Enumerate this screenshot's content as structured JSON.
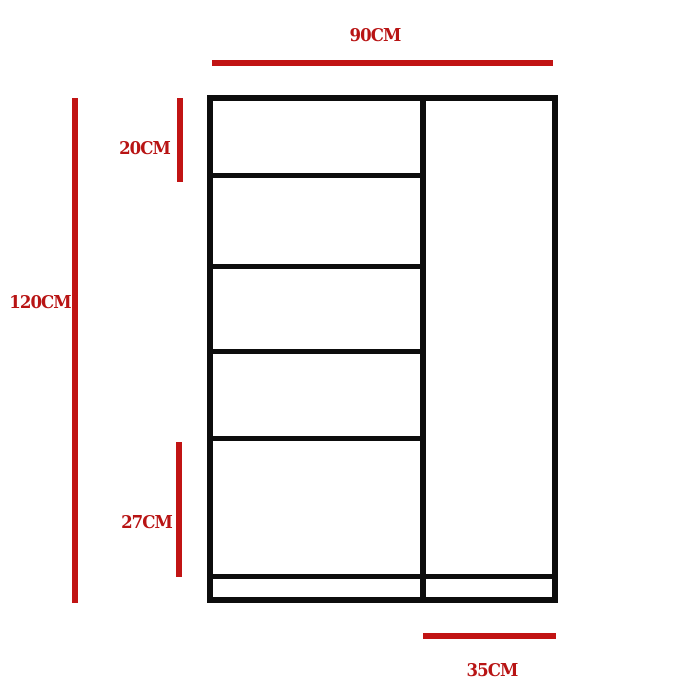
{
  "diagram": {
    "type": "furniture-dimension-drawing",
    "labels": {
      "width": "90CM",
      "height": "120CM",
      "top_compartment": "20CM",
      "bottom_compartment": "27CM",
      "right_column_width": "35CM"
    },
    "colors": {
      "dimension_line_red": "#c11414",
      "label_red": "#b81414",
      "outline_black": "#0d0d0d",
      "background": "#ffffff"
    },
    "structure": {
      "left_column_shelf_lines": 4,
      "left_column_compartments": 5,
      "right_column_compartments": 1,
      "has_base_plinth": true
    }
  }
}
